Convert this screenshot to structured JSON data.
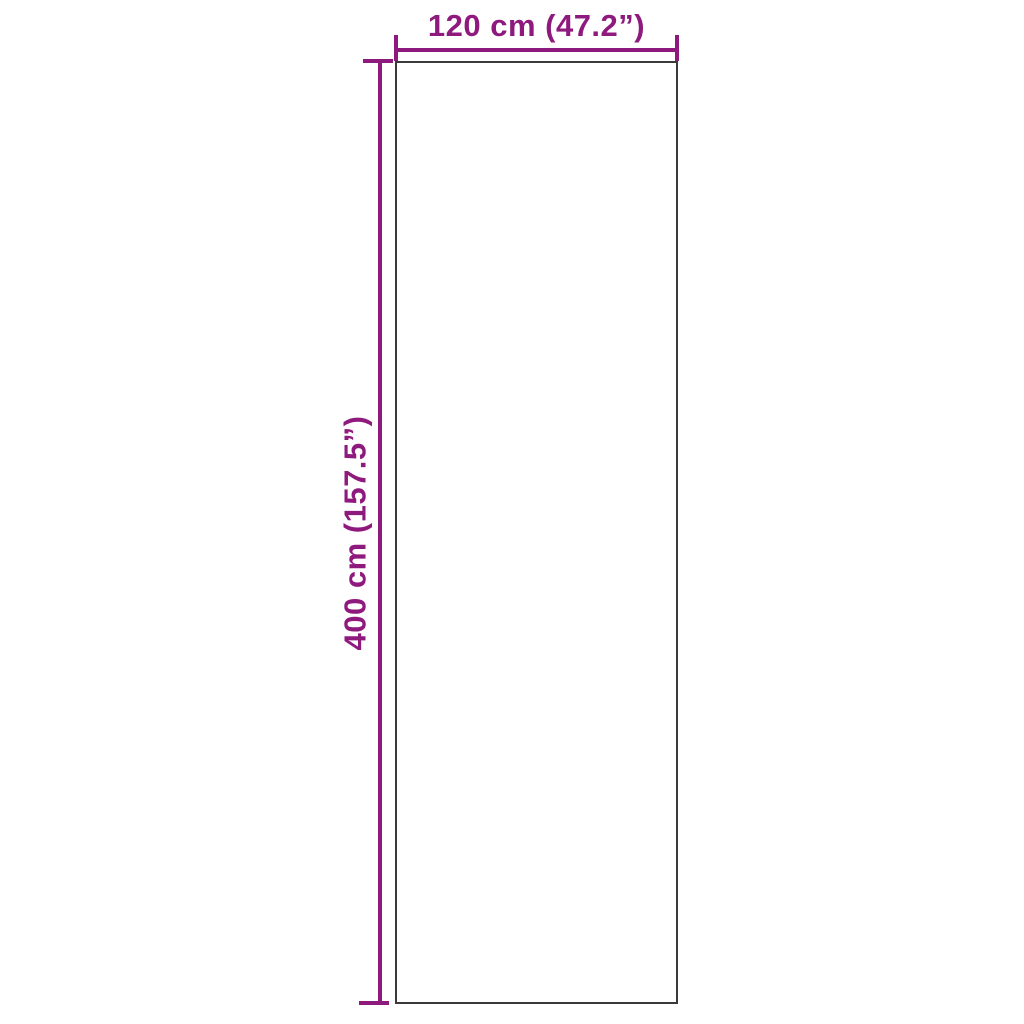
{
  "diagram": {
    "type": "product-dimension-diagram",
    "background_color": "#ffffff",
    "accent_color": "#8E1A7D",
    "outline_color": "#3a3a3a",
    "width_label": "120 cm (47.2”)",
    "height_label": "400 cm (157.5”)",
    "width_value_cm": 120,
    "width_value_inch": 47.2,
    "height_value_cm": 400,
    "height_value_inch": 157.5
  }
}
